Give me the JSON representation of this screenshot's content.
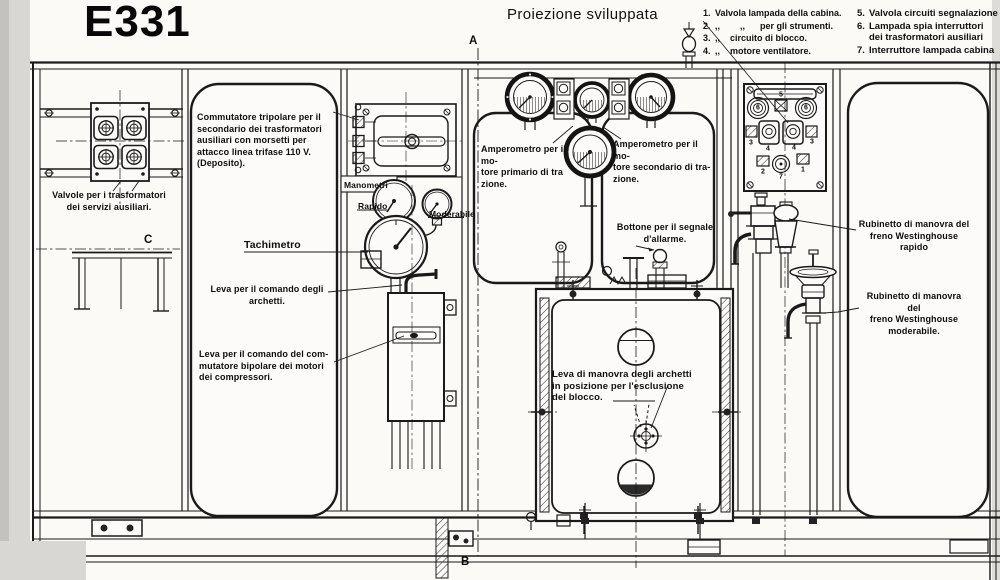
{
  "title": "E331",
  "subtitle": "Proiezione sviluppata",
  "legend": {
    "col1": [
      {
        "n": "1.",
        "t": "Valvola lampada della cabina."
      },
      {
        "n": "2.",
        "t": ",,        ,,      per gli strumenti."
      },
      {
        "n": "3.",
        "t": ",,    circuito di blocco."
      },
      {
        "n": "4.",
        "t": ",,    motore ventilatore."
      }
    ],
    "col2": [
      {
        "n": "5.",
        "t": "Valvola circuiti segnalazione"
      },
      {
        "n": "6.",
        "t": [
          "Lampada spia interruttori",
          "dei trasformatori ausiliari"
        ]
      },
      {
        "n": "7.",
        "t": "Interruttore lampada cabina"
      }
    ]
  },
  "labels": {
    "commutatore": [
      "Commutatore tripolare per il",
      "secondario dei trasformatori",
      "ausiliari con morsetti per",
      "attacco linea trifase 110 V.",
      "(Deposito)."
    ],
    "valvole": [
      "Valvole per i trasformatori",
      "dei servizi ausiliari."
    ],
    "manometri": "Manometri",
    "rapido": "Rapido",
    "moderabile": "Moderabile",
    "tachimetro": "Tachimetro",
    "leva_archetti": [
      "Leva per il comando degli",
      "archetti."
    ],
    "leva_commutatore": [
      "Leva per il comando del com-",
      "mutatore bipolare dei motori",
      "dei compressori."
    ],
    "amp_primario": [
      "Amperometro per il mo-",
      "tore primario di tra",
      "zione."
    ],
    "amp_secondario": [
      "Amperometro per il mo-",
      "tore secondario di tra-",
      "zione."
    ],
    "bottone": [
      "Bottone per il segnale",
      "d'allarme."
    ],
    "leva_manovra": [
      "Leva di manovra degli archetti",
      "in posizione per l'esclusione",
      "del blocco."
    ],
    "rubinetto_rapido": [
      "Rubinetto di manovra del",
      "freno Westinghouse  rapido"
    ],
    "rubinetto_moderabile": [
      "Rubinetto di manovra del",
      "freno Westinghouse",
      "moderabile."
    ]
  },
  "markers": {
    "a": "A",
    "b": "B",
    "c": "C"
  },
  "panel": {
    "n1": "1",
    "n2": "2",
    "n3": "3",
    "n4": "4",
    "n5": "5",
    "n6": "6",
    "n7": "7"
  },
  "colors": {
    "ink": "#1a1a1a",
    "paper": "#fbfaf7",
    "scan_edge": "#d8d7d4"
  }
}
